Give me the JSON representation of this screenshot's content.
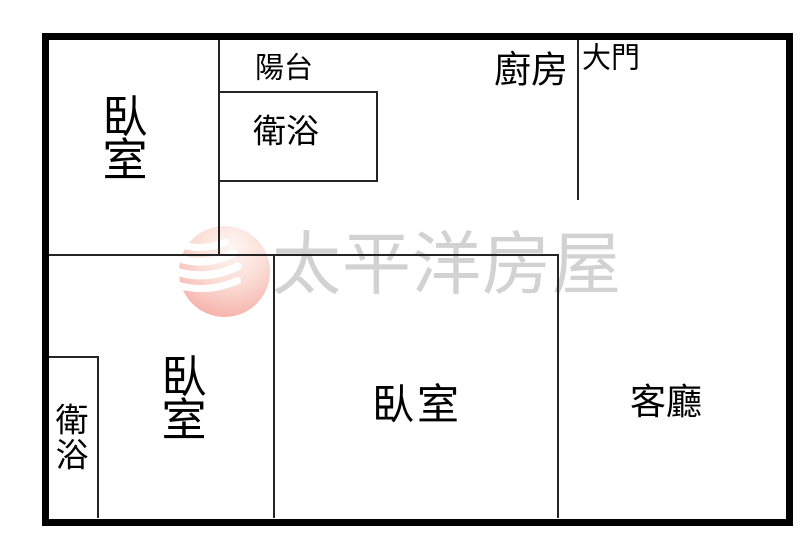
{
  "colors": {
    "outer_wall": "#000000",
    "inner_wall": "#242424",
    "label_text": "#000000",
    "watermark_text": "#d2d2d2",
    "logo_pink_deep": "#f3a89e",
    "logo_pink_light": "#fef5f1",
    "logo_wave": "#ffffff"
  },
  "watermark": {
    "brand_text": "太平洋房屋",
    "logo": "pacific-sphere-with-waves"
  },
  "rooms": {
    "bedroom_top_left": "臥室",
    "balcony": "陽台",
    "bathroom_top": "衛浴",
    "kitchen": "廚房",
    "main_door": "大門",
    "bedroom_bottom_left": "臥室",
    "bathroom_bottom": "衛浴",
    "bedroom_bottom_middle": "臥室",
    "living_room": "客廳"
  }
}
